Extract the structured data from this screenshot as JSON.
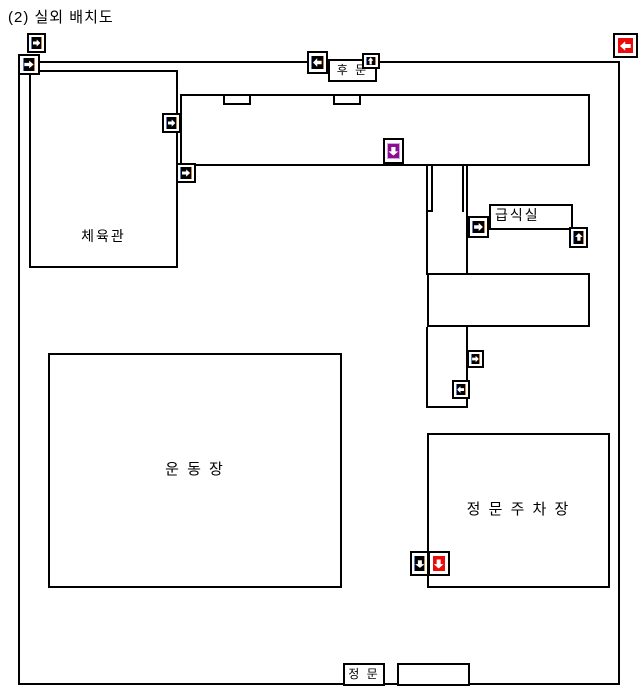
{
  "title": "(2) 실외 배치도",
  "colors": {
    "line": "#000000",
    "camera_black": "#000000",
    "camera_red": "#ea0b0b",
    "camera_purple": "#8d0d8d"
  },
  "diagram": {
    "boundary": {
      "x": 18,
      "y": 61,
      "w": 602,
      "h": 624
    },
    "rooms": [
      {
        "name": "gym",
        "label": "체육관",
        "x": 29,
        "y": 70,
        "w": 149,
        "h": 198,
        "labelPos": "bottom",
        "fontSize": 14
      },
      {
        "name": "main-building",
        "label": "",
        "x": 180,
        "y": 94,
        "w": 410,
        "h": 72,
        "labelPos": "center"
      },
      {
        "name": "entrance-notch-1",
        "label": "",
        "x": 223,
        "y": 94,
        "w": 28,
        "h": 11,
        "labelPos": "center"
      },
      {
        "name": "entrance-notch-2",
        "label": "",
        "x": 333,
        "y": 94,
        "w": 28,
        "h": 11,
        "labelPos": "center"
      },
      {
        "name": "back-gate",
        "label": "후 문",
        "x": 328,
        "y": 59,
        "w": 49,
        "h": 23,
        "labelPos": "center",
        "fontSize": 12
      },
      {
        "name": "cafeteria",
        "label": "급식실",
        "x": 489,
        "y": 204,
        "w": 84,
        "h": 26,
        "labelPos": "top-left",
        "fontSize": 14
      },
      {
        "name": "annex",
        "label": "",
        "x": 427,
        "y": 273,
        "w": 163,
        "h": 54,
        "labelPos": "center"
      },
      {
        "name": "playground",
        "label": "운 동 장",
        "x": 48,
        "y": 353,
        "w": 294,
        "h": 235,
        "labelPos": "center",
        "fontSize": 15
      },
      {
        "name": "parking",
        "label": "정 문 주 차 장",
        "x": 427,
        "y": 433,
        "w": 183,
        "h": 155,
        "labelPos": "center",
        "fontSize": 15
      },
      {
        "name": "main-gate",
        "label": "정 문",
        "x": 343,
        "y": 663,
        "w": 42,
        "h": 23,
        "labelPos": "center",
        "fontSize": 12
      },
      {
        "name": "gate-side-box",
        "label": "",
        "x": 397,
        "y": 663,
        "w": 73,
        "h": 23,
        "labelPos": "center"
      }
    ],
    "walls": [
      {
        "x": 404,
        "y": 159,
        "w": 24,
        "h": 2
      },
      {
        "x": 426,
        "y": 159,
        "w": 2,
        "h": 116
      },
      {
        "x": 431,
        "y": 166,
        "w": 2,
        "h": 46
      },
      {
        "x": 426,
        "y": 210,
        "w": 7,
        "h": 2
      },
      {
        "x": 462,
        "y": 166,
        "w": 2,
        "h": 46
      },
      {
        "x": 466,
        "y": 166,
        "w": 2,
        "h": 109
      },
      {
        "x": 426,
        "y": 327,
        "w": 2,
        "h": 81
      },
      {
        "x": 466,
        "y": 327,
        "w": 2,
        "h": 81
      },
      {
        "x": 426,
        "y": 406,
        "w": 42,
        "h": 2
      }
    ],
    "cameras": [
      {
        "name": "cam-top-left-upper",
        "x": 27,
        "y": 33,
        "w": 19,
        "h": 20,
        "color": "black",
        "dir": "right"
      },
      {
        "name": "cam-top-left-lower",
        "x": 18,
        "y": 54,
        "w": 22,
        "h": 21,
        "color": "black",
        "dir": "right"
      },
      {
        "name": "cam-back-gate-left",
        "x": 307,
        "y": 51,
        "w": 21,
        "h": 23,
        "color": "black",
        "dir": "left"
      },
      {
        "name": "cam-back-gate-top",
        "x": 362,
        "y": 53,
        "w": 18,
        "h": 16,
        "color": "black",
        "dir": "up"
      },
      {
        "name": "cam-top-right",
        "x": 613,
        "y": 33,
        "w": 25,
        "h": 25,
        "color": "red",
        "dir": "left"
      },
      {
        "name": "cam-gym-upper",
        "x": 162,
        "y": 113,
        "w": 19,
        "h": 20,
        "color": "black",
        "dir": "right"
      },
      {
        "name": "cam-gym-lower",
        "x": 176,
        "y": 163,
        "w": 20,
        "h": 20,
        "color": "black",
        "dir": "right"
      },
      {
        "name": "cam-main-building",
        "x": 383,
        "y": 138,
        "w": 21,
        "h": 26,
        "color": "purple",
        "dir": "down"
      },
      {
        "name": "cam-cafeteria-left",
        "x": 468,
        "y": 216,
        "w": 21,
        "h": 22,
        "color": "black",
        "dir": "right"
      },
      {
        "name": "cam-cafeteria-right",
        "x": 569,
        "y": 227,
        "w": 19,
        "h": 21,
        "color": "black",
        "dir": "up"
      },
      {
        "name": "cam-corridor-upper",
        "x": 467,
        "y": 350,
        "w": 17,
        "h": 18,
        "color": "black",
        "dir": "right"
      },
      {
        "name": "cam-corridor-lower",
        "x": 452,
        "y": 380,
        "w": 18,
        "h": 19,
        "color": "black",
        "dir": "left"
      },
      {
        "name": "cam-parking-black",
        "x": 410,
        "y": 551,
        "w": 19,
        "h": 25,
        "color": "black",
        "dir": "down"
      },
      {
        "name": "cam-parking-red",
        "x": 428,
        "y": 551,
        "w": 22,
        "h": 25,
        "color": "red",
        "dir": "down"
      }
    ]
  }
}
